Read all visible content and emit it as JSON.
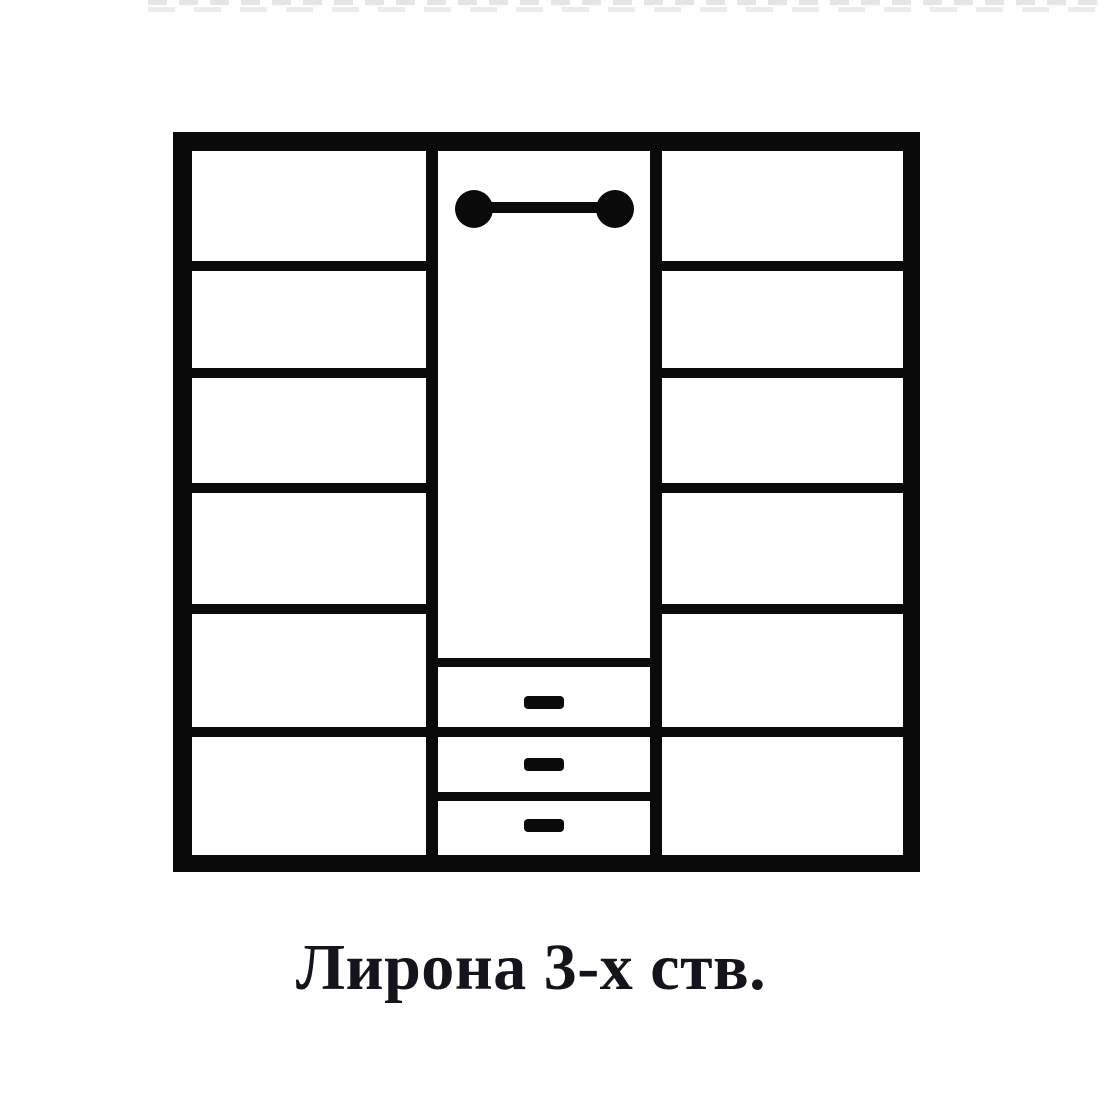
{
  "page": {
    "background": "#ffffff"
  },
  "diagram": {
    "kind": "wardrobe-front-schematic",
    "stroke_color": "#0a0a0a",
    "fill_color": "#ffffff",
    "left_column": {
      "compartments": 6
    },
    "right_column": {
      "compartments": 6
    },
    "middle_column": {
      "hanging_rods": 1,
      "drawers": 3,
      "drawer_handles": 3
    }
  },
  "caption": {
    "text": "Лирона 3-х ств.",
    "color": "#14141c"
  }
}
